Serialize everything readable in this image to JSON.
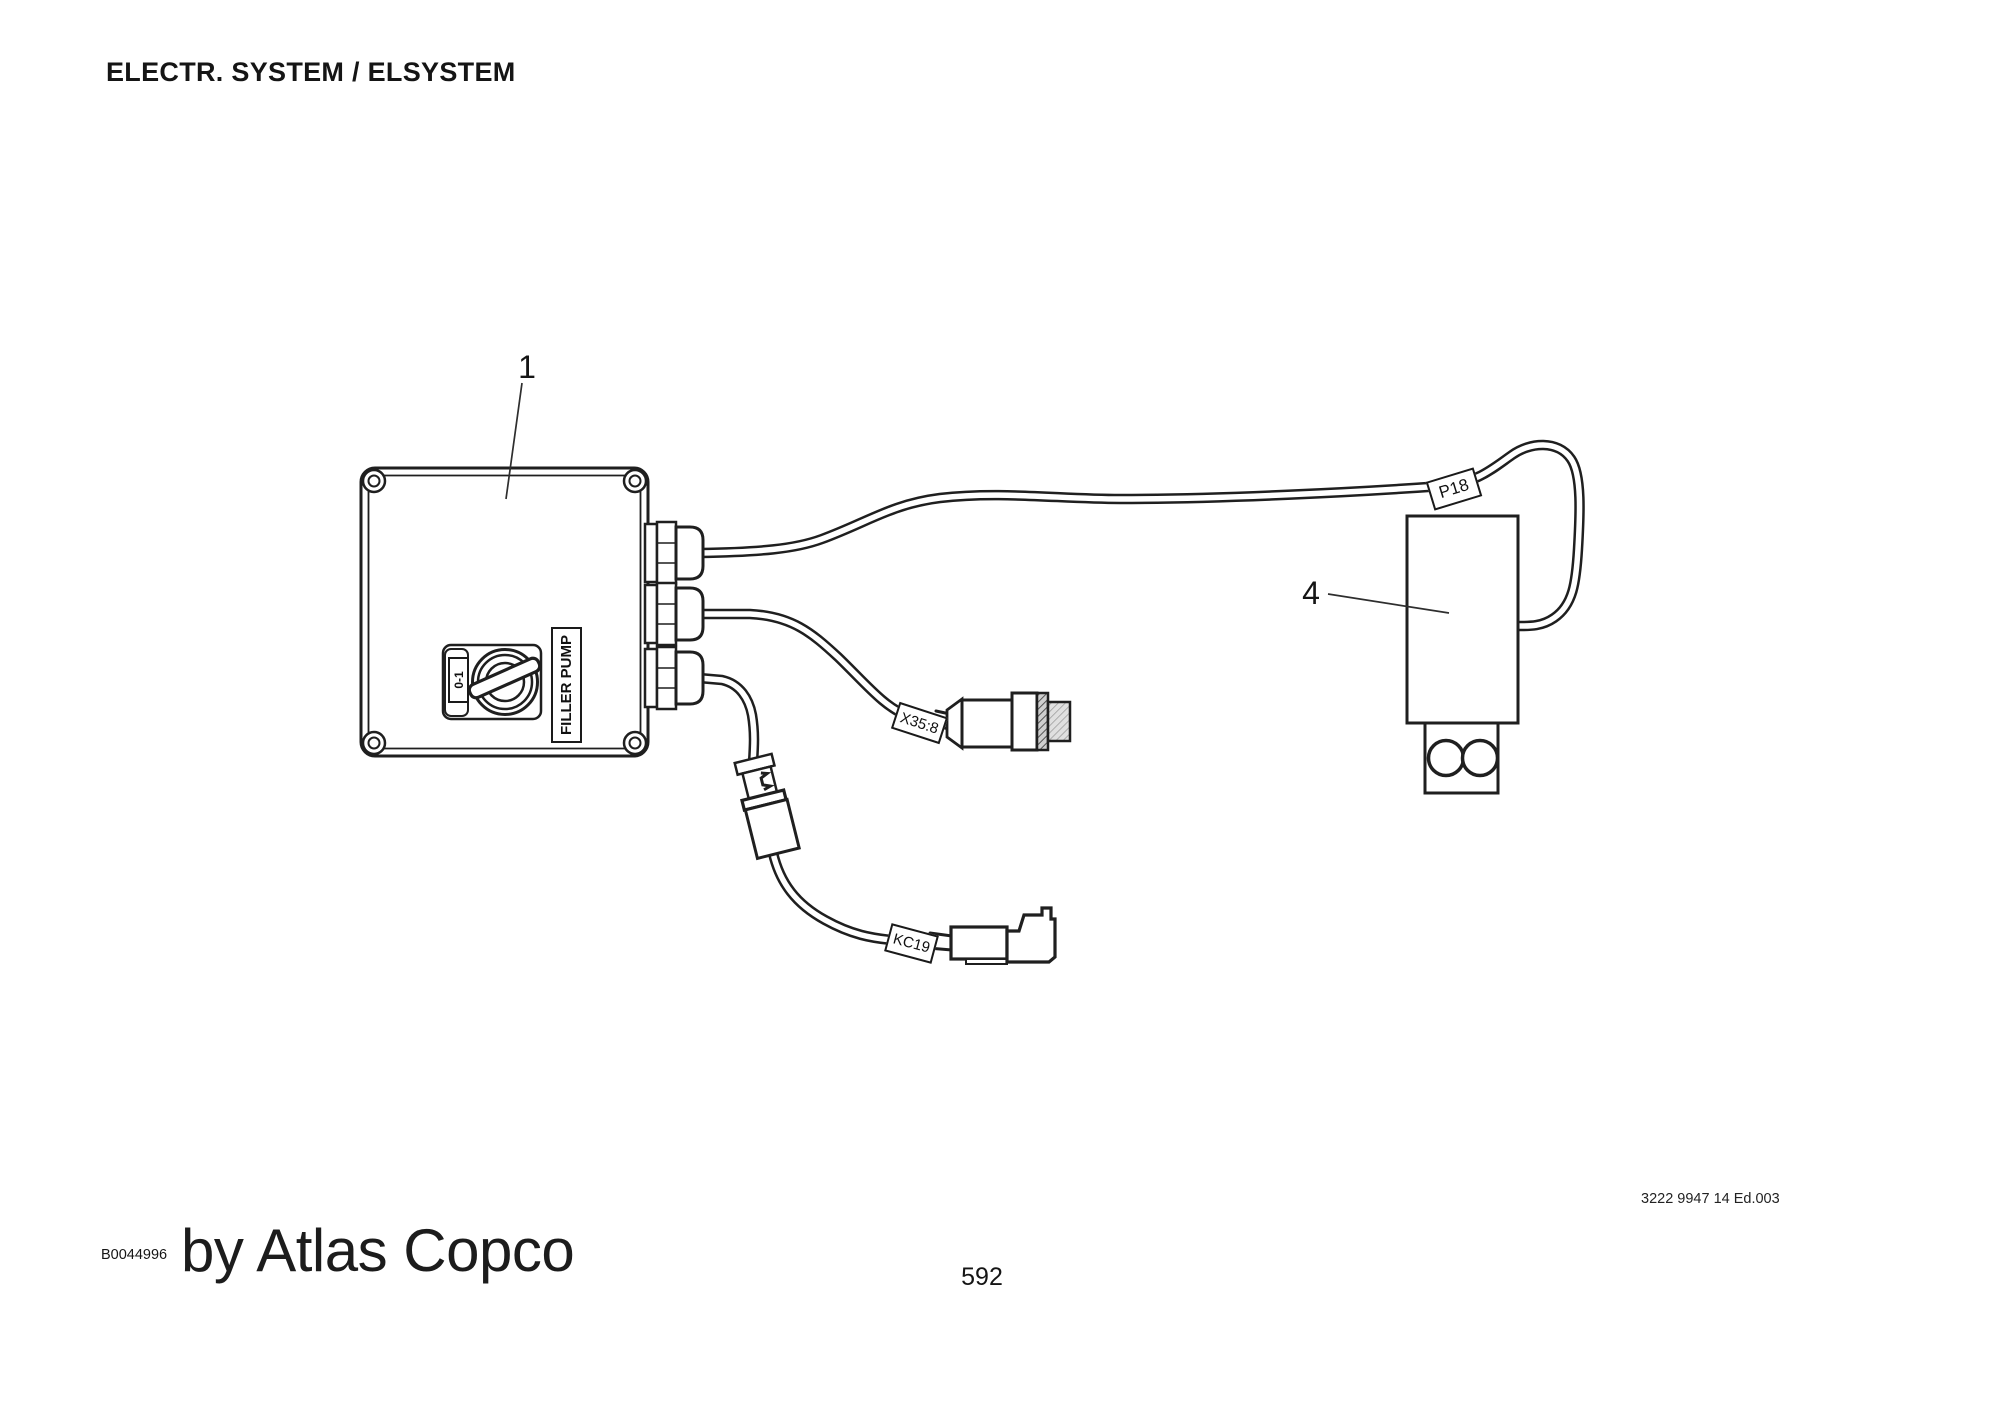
{
  "page": {
    "title": "ELECTR. SYSTEM / ELSYSTEM",
    "page_number": "592",
    "edition_code": "3222 9947 14 Ed.003",
    "figure_code": "B0044996",
    "brand_line": "by Atlas Copco"
  },
  "diagram": {
    "callouts": {
      "item1": "1",
      "item4": "4"
    },
    "control_box": {
      "switch_position_label": "0-1",
      "switch_function_label": "FILLER PUMP"
    },
    "wire_tags": {
      "p18": "P18",
      "x35_8": "X35:8",
      "kc19": "KC19"
    },
    "colors": {
      "background": "#ffffff",
      "line": "#1f1f1f",
      "text": "#111111"
    }
  }
}
